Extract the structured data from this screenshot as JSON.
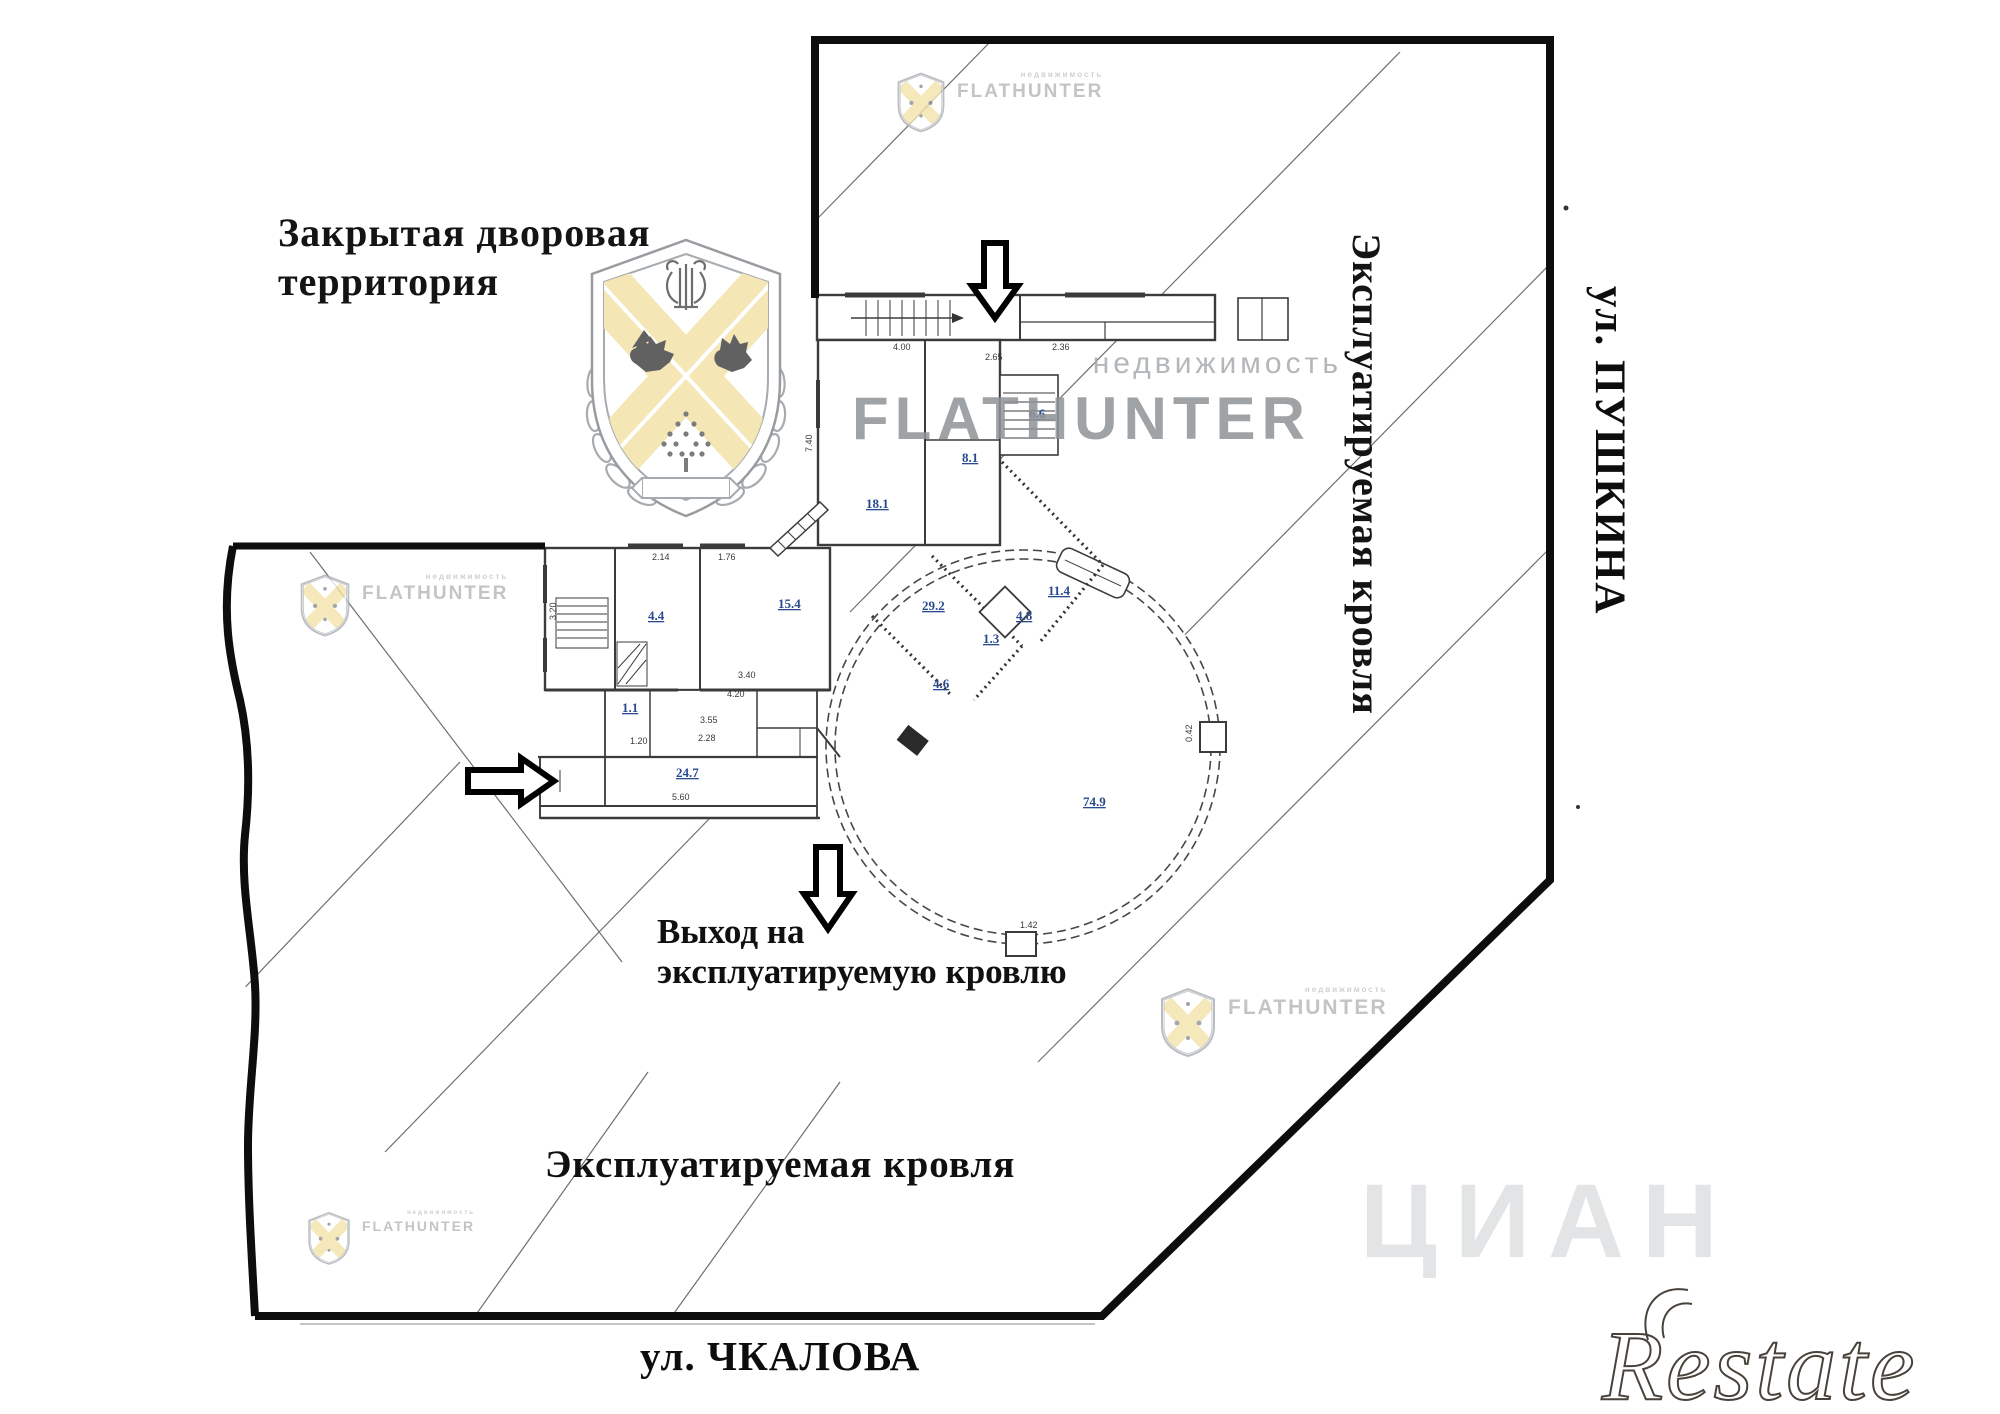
{
  "labels": {
    "yard": {
      "line1": "Закрытая дворовая",
      "line2": "территория"
    },
    "exit": {
      "line1": "Выход на",
      "line2": "эксплуатируемую кровлю"
    },
    "roof_right": "Эксплуатируемая кровля",
    "roof_bottom": "Эксплуатируемая кровля",
    "street_right": "ул. ПУШКИНА",
    "street_bottom": "ул. ЧКАЛОВА"
  },
  "watermarks": {
    "brand": "FLATHUNTER",
    "brand_sub": "недвижимость",
    "wordmark": "FLATHUNTER",
    "wordmark_sub": "недвижимость",
    "restate": "Restate",
    "cian": "ЦИАН"
  },
  "colors": {
    "boundary": "#0d0d0d",
    "wall": "#3b3b3b",
    "hatch": "#6f6f6f",
    "room_label_blue": "#2a4a8f",
    "dimension_gray": "#3a3a3a",
    "watermark_gray": "#b3b6b9",
    "wordmark_gray": "#8f9397",
    "shield_yellow": "#f3e3ab",
    "restate_outline": "#49423a"
  },
  "icons": {
    "shield": "flathunter-shield-icon",
    "arrows": [
      "down-arrow-icon",
      "right-arrow-icon",
      "down-arrow-icon"
    ]
  },
  "plan": {
    "room_labels": [
      {
        "text": "18.1",
        "x": 866,
        "y": 508
      },
      {
        "text": "8.1",
        "x": 962,
        "y": 462
      },
      {
        "text": "6.6",
        "x": 1029,
        "y": 418
      },
      {
        "text": "29.2",
        "x": 922,
        "y": 610
      },
      {
        "text": "11.4",
        "x": 1048,
        "y": 595
      },
      {
        "text": "1.3",
        "x": 983,
        "y": 643
      },
      {
        "text": "4.8",
        "x": 1016,
        "y": 620
      },
      {
        "text": "4.6",
        "x": 933,
        "y": 688
      },
      {
        "text": "15.4",
        "x": 778,
        "y": 608
      },
      {
        "text": "4.4",
        "x": 648,
        "y": 620
      },
      {
        "text": "1.1",
        "x": 622,
        "y": 712
      },
      {
        "text": "24.7",
        "x": 676,
        "y": 777
      },
      {
        "text": "74.9",
        "x": 1083,
        "y": 806
      }
    ],
    "dimension_labels": [
      {
        "text": "4.00",
        "x": 893,
        "y": 350
      },
      {
        "text": "2.36",
        "x": 1052,
        "y": 350
      },
      {
        "text": "2.65",
        "x": 985,
        "y": 360
      },
      {
        "text": "2.14",
        "x": 652,
        "y": 560
      },
      {
        "text": "1.76",
        "x": 718,
        "y": 560
      },
      {
        "text": "3.40",
        "x": 738,
        "y": 678
      },
      {
        "text": "4.20",
        "x": 727,
        "y": 697
      },
      {
        "text": "3.55",
        "x": 700,
        "y": 723
      },
      {
        "text": "2.28",
        "x": 698,
        "y": 741
      },
      {
        "text": "1.20",
        "x": 630,
        "y": 744
      },
      {
        "text": "5.60",
        "x": 672,
        "y": 800
      },
      {
        "text": "1.42",
        "x": 1020,
        "y": 928
      },
      {
        "text": "0.42",
        "x": 1192,
        "y": 742,
        "rotate": -90
      },
      {
        "text": "7.40",
        "x": 812,
        "y": 452,
        "rotate": -90
      },
      {
        "text": "3.20",
        "x": 556,
        "y": 620,
        "rotate": -90
      }
    ]
  }
}
